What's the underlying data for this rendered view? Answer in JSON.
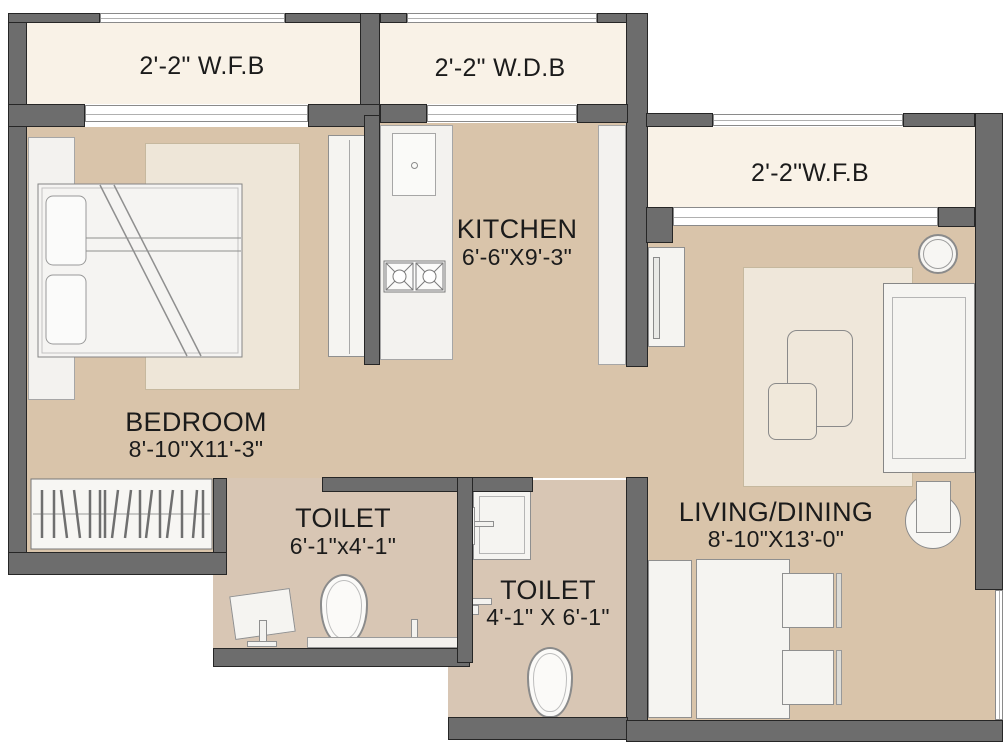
{
  "rooms": {
    "bedroom": {
      "name": "BEDROOM",
      "dims": "8'-10\"X11'-3\""
    },
    "kitchen": {
      "name": "KITCHEN",
      "dims": "6'-6\"X9'-3\""
    },
    "living": {
      "name": "LIVING/DINING",
      "dims": "8'-10\"X13'-0\""
    },
    "toilet1": {
      "name": "TOILET",
      "dims": "6'-1\"x4'-1\""
    },
    "toilet2": {
      "name": "TOILET",
      "dims": "4'-1\" X 6'-1\""
    }
  },
  "balconies": {
    "top_left": {
      "label": "2'-2\" W.F.B"
    },
    "top_mid": {
      "label": "2'-2\" W.D.B"
    },
    "right": {
      "label": "2'-2\"W.F.B"
    }
  },
  "colors": {
    "wall": "#6d6d6d",
    "wall_outline": "#262626",
    "floor": "#d9c4aa",
    "toilet_floor": "#d8c6b4",
    "balcony_floor": "#f9f2e7",
    "furniture": "#f5f4f1",
    "rug": "#eee6d8",
    "text": "#1b1b1b"
  }
}
